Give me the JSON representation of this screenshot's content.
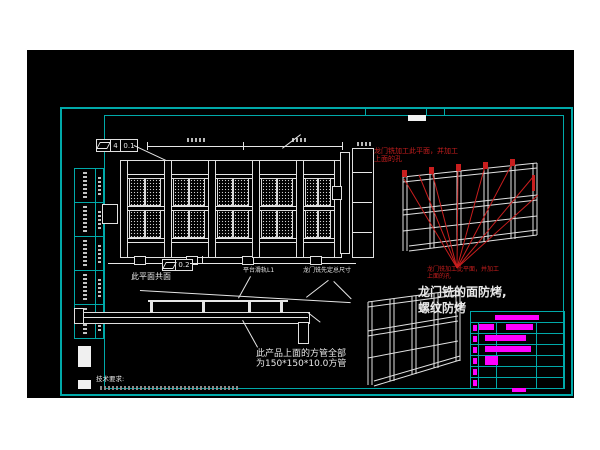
{
  "colors": {
    "page": "#ffffff",
    "canvas": "#000000",
    "frame_teal": "#00a9a9",
    "drawing_line": "#e6e6e6",
    "annotation_red": "#c81e1e",
    "highlight_magenta": "#ff00ff"
  },
  "notes": {
    "red_top": [
      "龙门铣加工此平面，并加工",
      "上面的孔"
    ],
    "red_mid": [
      "龙门铣加工此平面，并加工",
      "上面的孔"
    ],
    "big_white": [
      "龙门铣的面防烤,",
      "螺纹防烤"
    ],
    "square_tube": [
      "此产品上面的方管全部",
      "为150*150*10.0方管"
    ],
    "coplanar": "此平面共面",
    "platform": "平台滑轨L1",
    "gantry_size": "龙门铣先定总尺寸",
    "tech_req": "技术要求:"
  },
  "fcf": {
    "fcf1": {
      "symbol": "flatness",
      "count": "4",
      "value": "0.1"
    },
    "fcf2": {
      "symbol": "flatness",
      "value": "0.2"
    }
  },
  "front_view": {
    "bays": [
      [
        10,
        38
      ],
      [
        54,
        38
      ],
      [
        98,
        38
      ],
      [
        142,
        38
      ],
      [
        186,
        32
      ]
    ],
    "mullions": [
      4,
      48,
      92,
      136,
      180,
      218
    ],
    "panel_rows": [
      26,
      58
    ]
  },
  "left_strip": {
    "rows": 5
  },
  "process_table": {
    "rows": [
      {
        "square": true,
        "bars": [
          {
            "x": 8,
            "w": 15,
            "h": 6
          },
          {
            "x": 35,
            "w": 27,
            "h": 6
          }
        ]
      },
      {
        "square": true,
        "bars": [
          {
            "x": 14,
            "w": 41,
            "h": 6
          }
        ]
      },
      {
        "square": true,
        "bars": [
          {
            "x": 14,
            "w": 46,
            "h": 6
          }
        ]
      },
      {
        "square": true,
        "bars": [
          {
            "x": 14,
            "w": 13,
            "h": 9
          }
        ]
      },
      {
        "square": true,
        "bars": []
      },
      {
        "square": true,
        "bars": []
      }
    ]
  }
}
